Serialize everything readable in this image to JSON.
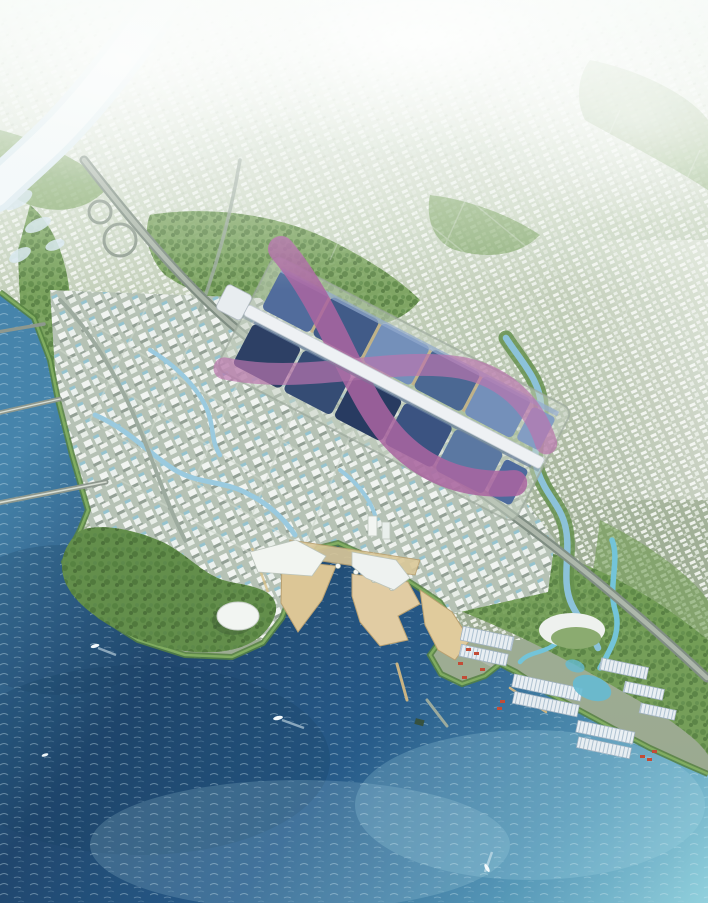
{
  "meta": {
    "title": "Aerial master-plan rendering of a coastal city district",
    "media_type": "architectural bird's-eye rendering",
    "canvas": {
      "width": 708,
      "height": 903
    },
    "visible_text": []
  },
  "palette": {
    "haze_white": "#f7fbf8",
    "land_light": "#eef3ea",
    "land_mid": "#c8d4bf",
    "land_deep": "#9dac92",
    "park_green": "#6d9a4e",
    "tree_dark": "#4d7a38",
    "near_city_base": "#b3c0b2",
    "building_white": "#f2f5f1",
    "glass_teal": "#7fb9c9",
    "road_grey": "#7b8a7e",
    "road_light": "#aab5a8",
    "river_white": "#f3f8fb",
    "canal_blue": "#96c8de",
    "cyan_canal": "#6ec2d8",
    "sea_deep": "#173f68",
    "sea_mid": "#1f5585",
    "sea_light": "#3f7fa8",
    "sea_turquoise": "#8ecfdc",
    "wave_foam": "#d8eef5",
    "sand_tan": "#dbc492",
    "roof_navy": "#25395f",
    "roof_blue": "#44628f",
    "roof_steel": "#6f8cb8",
    "ribbon_pink": "#a85f9e",
    "ribbon_pink_light": "#b96fab",
    "spine_white": "#eef1f4",
    "dome_white": "#f2f5f2",
    "warehouse_white": "#e8eef2",
    "warehouse_stripe": "#9db5c8",
    "container_red": "#c0452e",
    "shore_green": "#4f7c39",
    "boat_white": "#f4fafc"
  },
  "scene": {
    "description": "Bird's-eye architectural rendering of a planned waterfront district: a long exhibition/convention complex with dark-blue vaulted roofs crossed by pink ribbon canopies and a white central axis sits mid-frame; dense white mid-rise city blocks with canals spread toward a deep blue sea at lower left; a green peninsula with a white dome, sandy plaza piers, a logistics port with striped warehouse sheds and red containers occupy the waterfront; hazy city grid fades to white at the horizon; a white river and highway corridor cross the upper left.",
    "regions": [
      {
        "name": "hazy-horizon-city",
        "position": "top"
      },
      {
        "name": "white-river",
        "position": "upper-left diagonal"
      },
      {
        "name": "highway-corridor",
        "position": "upper-left to lower-right diagonal"
      },
      {
        "name": "exhibition-center",
        "position": "center"
      },
      {
        "name": "near-city-blocks",
        "position": "center-left"
      },
      {
        "name": "sea",
        "position": "lower-left"
      },
      {
        "name": "green-peninsula",
        "position": "lower-center-left"
      },
      {
        "name": "waterfront-piers",
        "position": "lower-center"
      },
      {
        "name": "logistics-port",
        "position": "lower-right"
      },
      {
        "name": "right-bank-city-grid",
        "position": "right"
      }
    ],
    "landmarks": [
      {
        "name": "exhibition-hall-roofs",
        "color_key": "roof_navy"
      },
      {
        "name": "pink-ribbon-canopy",
        "color_key": "ribbon_pink"
      },
      {
        "name": "central-axis-spine",
        "color_key": "spine_white"
      },
      {
        "name": "white-dome-building",
        "color_key": "dome_white"
      },
      {
        "name": "crescent-hall",
        "color_key": "building_white"
      }
    ],
    "counts": {
      "boats": 4,
      "bridges": 3,
      "exhibition_hall_bays": 10,
      "warehouse_sheds": 9
    }
  }
}
